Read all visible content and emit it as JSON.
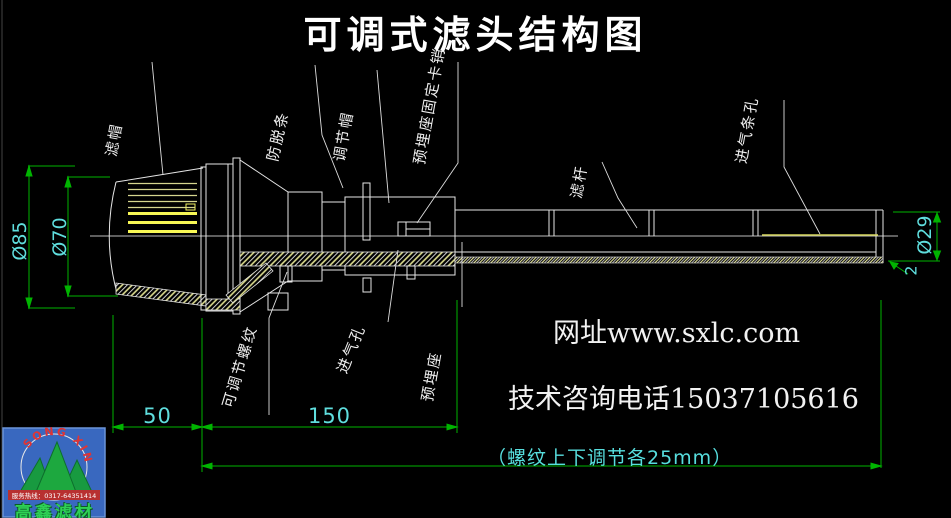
{
  "title": "可调式滤头结构图",
  "callouts": [
    {
      "label": "滤帽"
    },
    {
      "label": "防脱条"
    },
    {
      "label": "调节帽"
    },
    {
      "label": "预埋座固定卡销"
    },
    {
      "label": "滤杆"
    },
    {
      "label": "进气条孔"
    },
    {
      "label": "可调节螺纹"
    },
    {
      "label": "进气孔"
    },
    {
      "label": "预埋座"
    }
  ],
  "dimensions": {
    "cap_outer_dia": "Ø85",
    "cap_inner_dia": "Ø70",
    "rod_dia": "Ø29",
    "wall_thickness": "2",
    "cap_length": "50",
    "body_length": "150",
    "adjust_note": "（螺纹上下调节各25mm）"
  },
  "watermark": {
    "website": "网址www.sxlc.com",
    "phone": "技术咨询电话15037105616"
  },
  "logo": {
    "arc_text": "SONG XIN",
    "hotline": "服务热线：0317-64351414",
    "company": "高鑫滤材"
  },
  "colors": {
    "background": "#000000",
    "line_white": "#e6e6e6",
    "dim_green": "#00b400",
    "dim_cyan": "#5fdede",
    "slot_yellow": "#f8f855",
    "logo_blue": "#3968bf"
  }
}
